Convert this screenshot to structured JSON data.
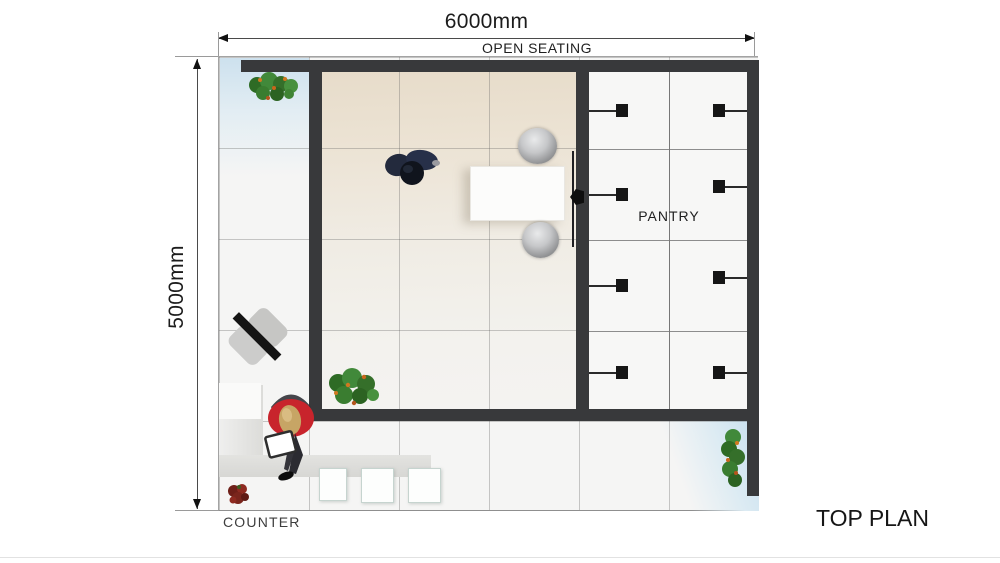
{
  "page": {
    "title": "TOP PLAN"
  },
  "dimensions": {
    "width": {
      "label": "6000mm"
    },
    "height": {
      "label": "5000mm"
    }
  },
  "areas": {
    "open_seating": "OPEN SEATING",
    "pantry": "PANTRY",
    "counter": "COUNTER"
  },
  "colors": {
    "wall": "#38393b",
    "dimension_line": "#4a4a4a",
    "text": "#1c1c1c",
    "floor_warm_beige": "#e7dcca",
    "floor_tint_blue": "#cde1ee",
    "counter_gray": "#dcdcd9",
    "person_jacket_red": "#c8242c",
    "person_navy": "#232a3d",
    "plant_green": "#3f7d2f",
    "cabinet_handle_black": "#161616"
  }
}
